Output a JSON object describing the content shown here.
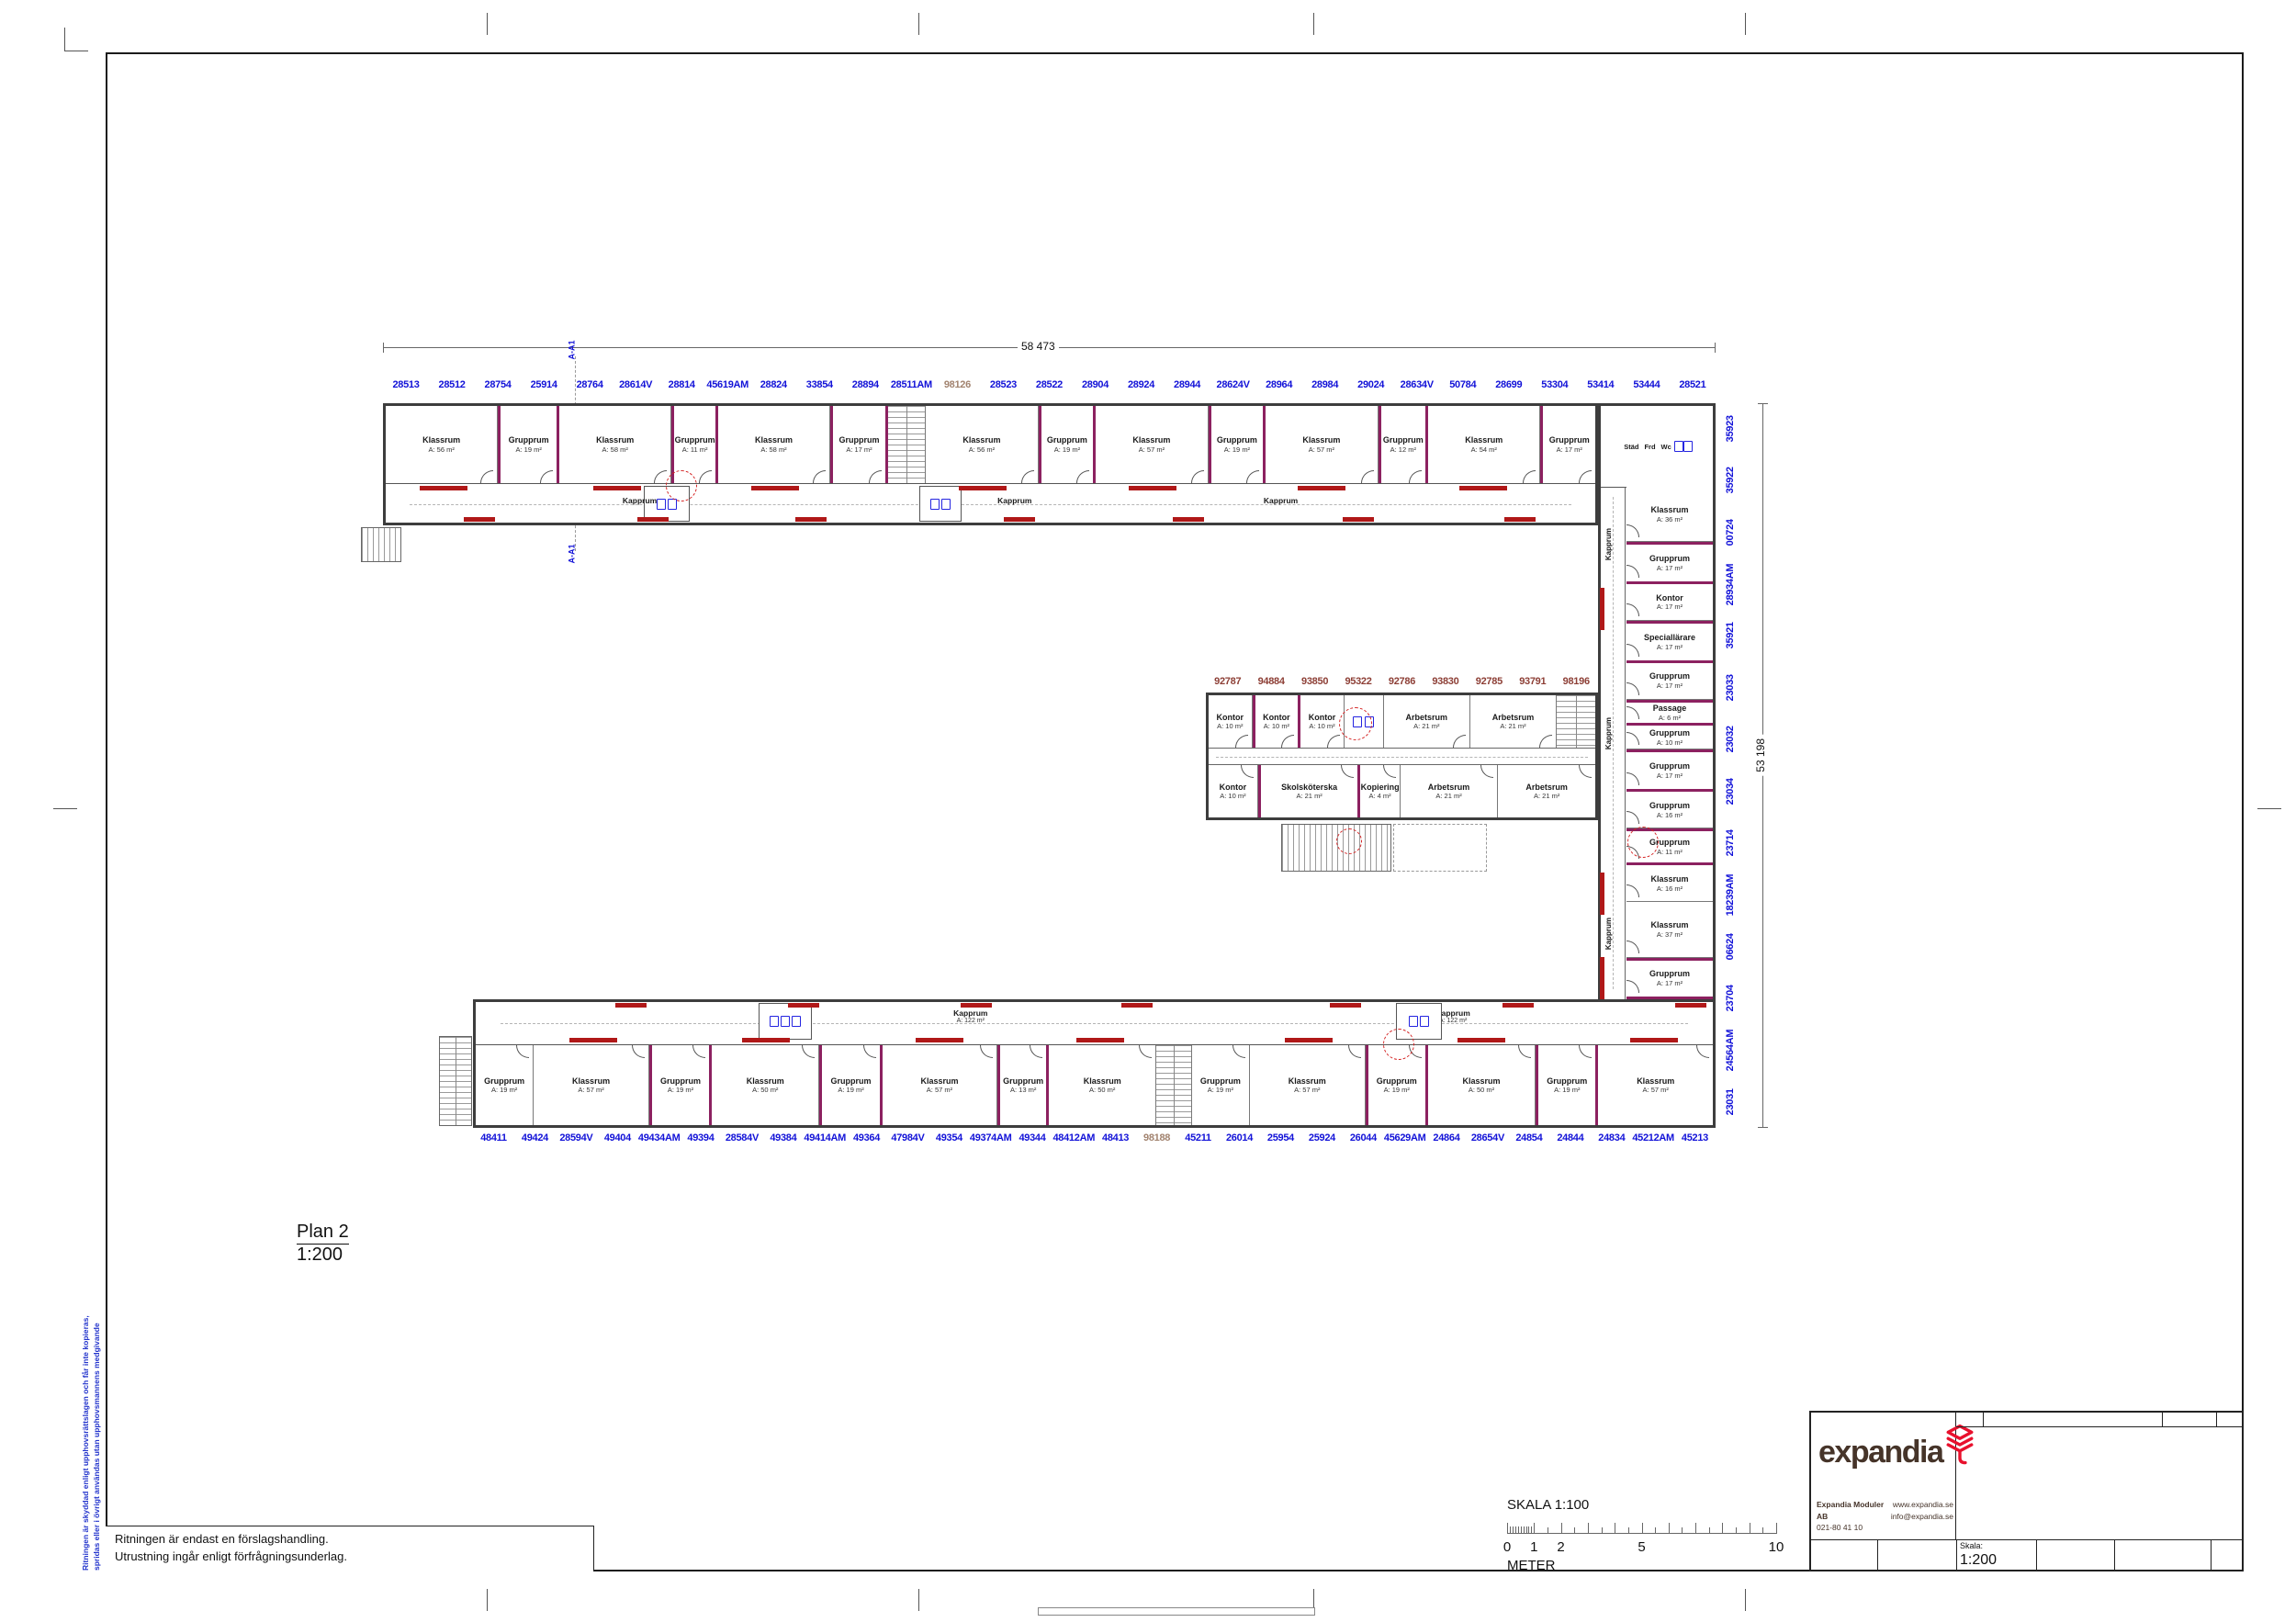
{
  "page": {
    "plan_label": "Plan 2",
    "plan_scale": "1:200",
    "dim_top": "58 473",
    "dim_right": "53 198",
    "section_mark": "A-A1",
    "notes": {
      "line1": "Ritningen är endast en förslagshandling.",
      "line2": "Utrustning ingår enligt förfrågningsunderlag."
    },
    "copyright": {
      "line1": "Ritningen är skyddad enligt upphovsrättslagen och får inte kopieras,",
      "line2": "spridas eller i övrigt användas utan upphovsmannens medgivande"
    }
  },
  "scalebar": {
    "title": "SKALA 1:100",
    "unit": "METER",
    "labels": [
      "0",
      "1",
      "2",
      "5",
      "10"
    ],
    "label_positions_m": [
      0,
      1,
      2,
      5,
      10
    ]
  },
  "titleblock": {
    "logo": "expandia",
    "company": "Expandia Moduler AB",
    "phone": "021-80 41 10",
    "website": "www.expandia.se",
    "email": "info@expandia.se",
    "scale_label": "Skala:",
    "scale_value": "1:200",
    "brand_red": "#e8112d",
    "brand_brown": "#463429"
  },
  "colors": {
    "module_number_blue": "#1212d8",
    "module_number_maroon": "#8d3f36",
    "module_number_highlight": "#a2836f",
    "module_joint_purple": "#8c2160",
    "corridor_bench_red": "#b01818",
    "fixture_blue": "#2424e0",
    "wall_dark": "#3d3d3d"
  },
  "modules": {
    "top": [
      "28513",
      "28512",
      "28754",
      "25914",
      "28764",
      "28614V",
      "28814",
      "45619AM",
      "28824",
      "33854",
      "28894",
      "28511AM",
      "98126",
      "28523",
      "28522",
      "28904",
      "28924",
      "28944",
      "28624V",
      "28964",
      "28984",
      "29024",
      "28634V",
      "50784",
      "28699",
      "53304",
      "53414",
      "53444",
      "28521"
    ],
    "middle": [
      "92787",
      "94884",
      "93850",
      "95322",
      "92786",
      "93830",
      "92785",
      "93791",
      "98196"
    ],
    "right": [
      "35923",
      "35922",
      "00724",
      "28934AM",
      "35921",
      "23033",
      "23032",
      "23034",
      "23714",
      "18239AM",
      "06624",
      "23704",
      "24564AM",
      "23031"
    ],
    "bottom": [
      "48411",
      "49424",
      "28594V",
      "49404",
      "49434AM",
      "49394",
      "28584V",
      "49384",
      "49414AM",
      "49364",
      "47984V",
      "49354",
      "49374AM",
      "49344",
      "48412AM",
      "48413",
      "98188",
      "45211",
      "26014",
      "25954",
      "25924",
      "26044",
      "45629AM",
      "24864",
      "28654V",
      "24854",
      "24844",
      "24834",
      "45212AM",
      "45213"
    ],
    "highlighted": [
      "98126",
      "98188"
    ]
  },
  "labels": {
    "kapprum": "Kapprum",
    "kapprum_area": "A: 122 m²",
    "stad": "Städ",
    "frd": "Frd",
    "wc": "Wc"
  },
  "rooms": {
    "top_wing": [
      {
        "n": "Klassrum",
        "a": "A: 56 m²",
        "w": 3
      },
      {
        "n": "Grupprum",
        "a": "A: 19 m²",
        "w": 1.5,
        "j": 1
      },
      {
        "n": "Klassrum",
        "a": "A: 58 m²",
        "w": 3
      },
      {
        "n": "Grupprum",
        "a": "A: 11 m²",
        "w": 1.1,
        "j": 1
      },
      {
        "n": "Klassrum",
        "a": "A: 58 m²",
        "w": 3
      },
      {
        "n": "Grupprum",
        "a": "A: 17 m²",
        "w": 1.4,
        "j": 1
      },
      {
        "t": "stair",
        "w": 1
      },
      {
        "n": "Klassrum",
        "a": "A: 56 m²",
        "w": 3
      },
      {
        "n": "Grupprum",
        "a": "A: 19 m²",
        "w": 1.4,
        "j": 1
      },
      {
        "n": "Klassrum",
        "a": "A: 57 m²",
        "w": 3
      },
      {
        "n": "Grupprum",
        "a": "A: 19 m²",
        "w": 1.4,
        "j": 1
      },
      {
        "n": "Klassrum",
        "a": "A: 57 m²",
        "w": 3
      },
      {
        "n": "Grupprum",
        "a": "A: 12 m²",
        "w": 1.2,
        "j": 1
      },
      {
        "n": "Klassrum",
        "a": "A: 54 m²",
        "w": 3
      },
      {
        "n": "Grupprum",
        "a": "A: 17 m²",
        "w": 1.4,
        "j": 1
      }
    ],
    "right_wing": [
      {
        "n": "Klassrum",
        "a": "A: 36 m²",
        "w": 6
      },
      {
        "n": "Grupprum",
        "a": "A: 17 m²",
        "w": 4,
        "j": 1
      },
      {
        "n": "Kontor",
        "a": "A: 17 m²",
        "w": 4
      },
      {
        "n": "Speciallärare",
        "a": "A: 17 m²",
        "w": 4,
        "j": 1
      },
      {
        "n": "Grupprum",
        "a": "A: 17 m²",
        "w": 4
      },
      {
        "n": "Passage",
        "a": "A: 6 m²",
        "w": 2.2,
        "j": 1
      },
      {
        "n": "Grupprum",
        "a": "A: 10 m²",
        "w": 2.6
      },
      {
        "n": "Grupprum",
        "a": "A: 17 m²",
        "w": 4,
        "j": 1
      },
      {
        "n": "Grupprum",
        "a": "A: 16 m²",
        "w": 4
      },
      {
        "n": "Grupprum",
        "a": "A: 11 m²",
        "w": 3.4,
        "j": 1
      },
      {
        "n": "Klassrum",
        "a": "A: 16 m²",
        "w": 4
      },
      {
        "n": "Klassrum",
        "a": "A: 37 m²",
        "w": 6
      },
      {
        "n": "Grupprum",
        "a": "A: 17 m²",
        "w": 4,
        "j": 1
      }
    ],
    "mid_top": [
      {
        "n": "Kontor",
        "a": "A: 10 m²",
        "w": 1
      },
      {
        "n": "Kontor",
        "a": "A: 10 m²",
        "w": 1,
        "j": 1
      },
      {
        "n": "Kontor",
        "a": "A: 10 m²",
        "w": 1
      },
      {
        "t": "wc",
        "w": 0.9
      },
      {
        "n": "Arbetsrum",
        "a": "A: 21 m²",
        "w": 2
      },
      {
        "n": "Arbetsrum",
        "a": "A: 21 m²",
        "w": 2
      },
      {
        "t": "stair",
        "w": 0.9
      }
    ],
    "mid_bottom": [
      {
        "n": "Kontor",
        "a": "A: 10 m²",
        "w": 1
      },
      {
        "n": "Skolsköterska",
        "a": "A: 21 m²",
        "w": 2,
        "j": 1
      },
      {
        "n": "Kopiering",
        "a": "A: 4 m²",
        "w": 0.8
      },
      {
        "n": "Arbetsrum",
        "a": "A: 21 m²",
        "w": 2
      },
      {
        "n": "Arbetsrum",
        "a": "A: 21 m²",
        "w": 2
      }
    ],
    "bottom_wing": [
      {
        "n": "Grupprum",
        "a": "A: 19 m²",
        "w": 1.5
      },
      {
        "n": "Klassrum",
        "a": "A: 57 m²",
        "w": 3
      },
      {
        "n": "Grupprum",
        "a": "A: 19 m²",
        "w": 1.5,
        "j": 1
      },
      {
        "n": "Klassrum",
        "a": "A: 50 m²",
        "w": 2.8
      },
      {
        "n": "Grupprum",
        "a": "A: 19 m²",
        "w": 1.5,
        "j": 1
      },
      {
        "n": "Klassrum",
        "a": "A: 57 m²",
        "w": 3
      },
      {
        "n": "Grupprum",
        "a": "A: 13 m²",
        "w": 1.2,
        "j": 1
      },
      {
        "n": "Klassrum",
        "a": "A: 50 m²",
        "w": 2.8
      },
      {
        "t": "stair",
        "w": 0.9
      },
      {
        "n": "Grupprum",
        "a": "A: 19 m²",
        "w": 1.5
      },
      {
        "n": "Klassrum",
        "a": "A: 57 m²",
        "w": 3
      },
      {
        "n": "Grupprum",
        "a": "A: 19 m²",
        "w": 1.5,
        "j": 1
      },
      {
        "n": "Klassrum",
        "a": "A: 50 m²",
        "w": 2.8
      },
      {
        "n": "Grupprum",
        "a": "A: 19 m²",
        "w": 1.5,
        "j": 1
      },
      {
        "n": "Klassrum",
        "a": "A: 57 m²",
        "w": 3
      }
    ]
  }
}
